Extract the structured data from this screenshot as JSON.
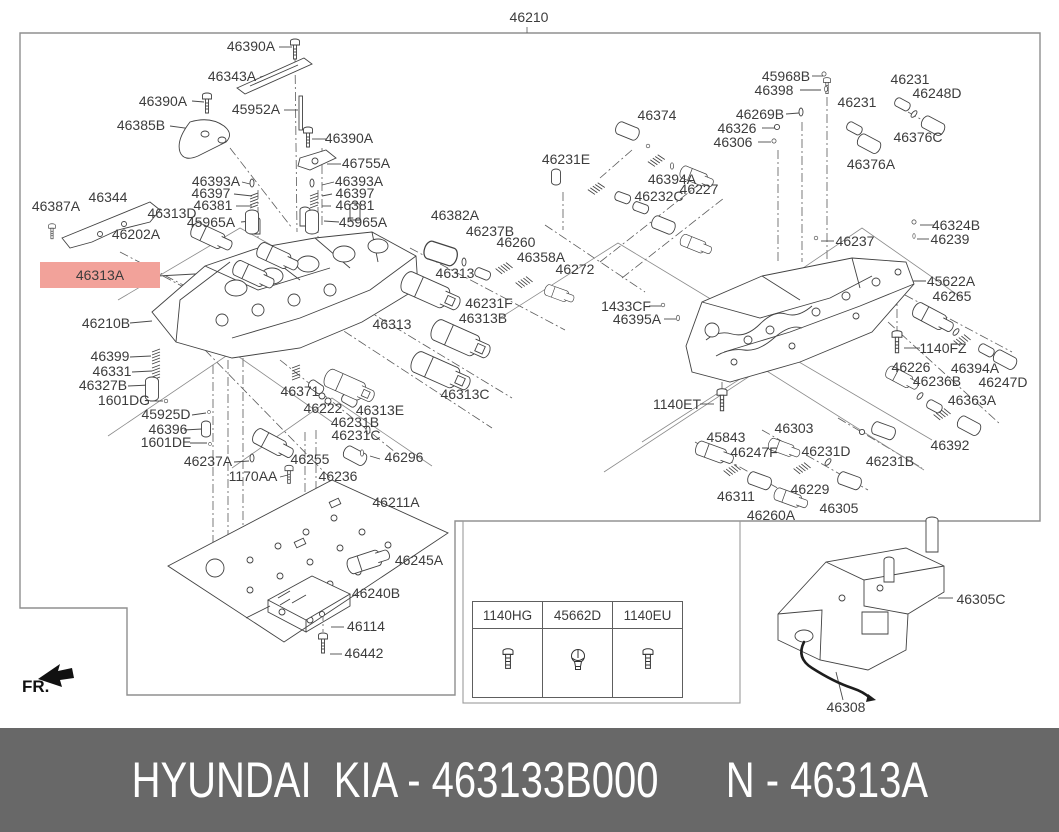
{
  "diagram": {
    "fr_label": "FR.",
    "highlight": {
      "bg_color": "#f2a29a",
      "text_color": "#c23b2c",
      "part": "46313A"
    },
    "labels": [
      {
        "t": "46210",
        "x": 529,
        "y": 22
      },
      {
        "t": "46390A",
        "x": 251,
        "y": 51
      },
      {
        "t": "46343A",
        "x": 232,
        "y": 81
      },
      {
        "t": "46390A",
        "x": 163,
        "y": 106
      },
      {
        "t": "45952A",
        "x": 256,
        "y": 114
      },
      {
        "t": "46385B",
        "x": 141,
        "y": 130
      },
      {
        "t": "46390A",
        "x": 349,
        "y": 143
      },
      {
        "t": "46755A",
        "x": 366,
        "y": 168
      },
      {
        "t": "46393A",
        "x": 216,
        "y": 186
      },
      {
        "t": "46397",
        "x": 211,
        "y": 198
      },
      {
        "t": "46381",
        "x": 213,
        "y": 210
      },
      {
        "t": "45965A",
        "x": 211,
        "y": 227
      },
      {
        "t": "46393A",
        "x": 359,
        "y": 186
      },
      {
        "t": "46397",
        "x": 355,
        "y": 198
      },
      {
        "t": "46381",
        "x": 355,
        "y": 210
      },
      {
        "t": "45965A",
        "x": 363,
        "y": 227
      },
      {
        "t": "46387A",
        "x": 56,
        "y": 211
      },
      {
        "t": "46344",
        "x": 108,
        "y": 202
      },
      {
        "t": "46313D",
        "x": 172,
        "y": 218
      },
      {
        "t": "46202A",
        "x": 136,
        "y": 239
      },
      {
        "t": "46313A",
        "x": 100,
        "y": 280,
        "hl": true
      },
      {
        "t": "46210B",
        "x": 106,
        "y": 328
      },
      {
        "t": "46399",
        "x": 110,
        "y": 361
      },
      {
        "t": "46331",
        "x": 112,
        "y": 376
      },
      {
        "t": "46327B",
        "x": 103,
        "y": 390
      },
      {
        "t": "1601DG",
        "x": 124,
        "y": 405
      },
      {
        "t": "45925D",
        "x": 166,
        "y": 419
      },
      {
        "t": "46396",
        "x": 168,
        "y": 434
      },
      {
        "t": "1601DE",
        "x": 166,
        "y": 447
      },
      {
        "t": "46237A",
        "x": 208,
        "y": 466
      },
      {
        "t": "1170AA",
        "x": 253,
        "y": 481
      },
      {
        "t": "46255",
        "x": 310,
        "y": 464
      },
      {
        "t": "46236",
        "x": 338,
        "y": 481
      },
      {
        "t": "46296",
        "x": 404,
        "y": 462
      },
      {
        "t": "46231C",
        "x": 356,
        "y": 440
      },
      {
        "t": "46231B",
        "x": 355,
        "y": 427
      },
      {
        "t": "46222",
        "x": 323,
        "y": 413
      },
      {
        "t": "46371",
        "x": 300,
        "y": 396
      },
      {
        "t": "46313E",
        "x": 380,
        "y": 415
      },
      {
        "t": "46313",
        "x": 392,
        "y": 329
      },
      {
        "t": "46211A",
        "x": 396,
        "y": 507
      },
      {
        "t": "46245A",
        "x": 419,
        "y": 565
      },
      {
        "t": "46240B",
        "x": 376,
        "y": 598
      },
      {
        "t": "46114",
        "x": 366,
        "y": 631
      },
      {
        "t": "46442",
        "x": 364,
        "y": 658
      },
      {
        "t": "46382A",
        "x": 455,
        "y": 220
      },
      {
        "t": "46237B",
        "x": 490,
        "y": 236
      },
      {
        "t": "46260",
        "x": 516,
        "y": 247
      },
      {
        "t": "46358A",
        "x": 541,
        "y": 262
      },
      {
        "t": "46272",
        "x": 575,
        "y": 274
      },
      {
        "t": "46313",
        "x": 455,
        "y": 278
      },
      {
        "t": "46231F",
        "x": 489,
        "y": 308
      },
      {
        "t": "46313B",
        "x": 483,
        "y": 323
      },
      {
        "t": "46313C",
        "x": 465,
        "y": 399
      },
      {
        "t": "46231E",
        "x": 566,
        "y": 164
      },
      {
        "t": "1433CF",
        "x": 626,
        "y": 311
      },
      {
        "t": "46395A",
        "x": 637,
        "y": 324
      },
      {
        "t": "1140ET",
        "x": 677,
        "y": 409
      },
      {
        "t": "46374",
        "x": 657,
        "y": 120
      },
      {
        "t": "46394A",
        "x": 672,
        "y": 184
      },
      {
        "t": "46232C",
        "x": 659,
        "y": 201
      },
      {
        "t": "46227",
        "x": 699,
        "y": 194
      },
      {
        "t": "45968B",
        "x": 786,
        "y": 81
      },
      {
        "t": "46398",
        "x": 774,
        "y": 95
      },
      {
        "t": "46269B",
        "x": 760,
        "y": 119
      },
      {
        "t": "46326",
        "x": 737,
        "y": 133
      },
      {
        "t": "46306",
        "x": 733,
        "y": 147
      },
      {
        "t": "46231",
        "x": 857,
        "y": 107
      },
      {
        "t": "46231",
        "x": 910,
        "y": 84
      },
      {
        "t": "46248D",
        "x": 937,
        "y": 98
      },
      {
        "t": "46376C",
        "x": 918,
        "y": 142
      },
      {
        "t": "46376A",
        "x": 871,
        "y": 169
      },
      {
        "t": "46324B",
        "x": 956,
        "y": 230
      },
      {
        "t": "46239",
        "x": 950,
        "y": 244
      },
      {
        "t": "46237",
        "x": 855,
        "y": 246
      },
      {
        "t": "45622A",
        "x": 951,
        "y": 286
      },
      {
        "t": "46265",
        "x": 952,
        "y": 301
      },
      {
        "t": "1140FZ",
        "x": 943,
        "y": 353
      },
      {
        "t": "46226",
        "x": 911,
        "y": 372
      },
      {
        "t": "46394A",
        "x": 975,
        "y": 373
      },
      {
        "t": "46236B",
        "x": 937,
        "y": 386
      },
      {
        "t": "46247D",
        "x": 1003,
        "y": 387
      },
      {
        "t": "46363A",
        "x": 972,
        "y": 405
      },
      {
        "t": "46392",
        "x": 950,
        "y": 450
      },
      {
        "t": "45843",
        "x": 726,
        "y": 442
      },
      {
        "t": "46303",
        "x": 794,
        "y": 433
      },
      {
        "t": "46247F",
        "x": 754,
        "y": 457
      },
      {
        "t": "46231D",
        "x": 826,
        "y": 456
      },
      {
        "t": "46231B",
        "x": 890,
        "y": 466
      },
      {
        "t": "46311",
        "x": 736,
        "y": 501
      },
      {
        "t": "46229",
        "x": 810,
        "y": 494
      },
      {
        "t": "46305",
        "x": 839,
        "y": 513
      },
      {
        "t": "46260A",
        "x": 771,
        "y": 520
      },
      {
        "t": "46305C",
        "x": 981,
        "y": 604
      },
      {
        "t": "46308",
        "x": 846,
        "y": 712
      }
    ]
  },
  "fasteners_table": {
    "columns": [
      {
        "code": "1140HG",
        "icon": "bolt-icon"
      },
      {
        "code": "45662D",
        "icon": "grommet-icon"
      },
      {
        "code": "1140EU",
        "icon": "bolt-icon"
      }
    ]
  },
  "footer": {
    "left_text": "HYUNDAI  KIA - 463133B000",
    "right_text": "N - 46313A",
    "bg_color": "#686868",
    "text_color": "#ffffff"
  }
}
